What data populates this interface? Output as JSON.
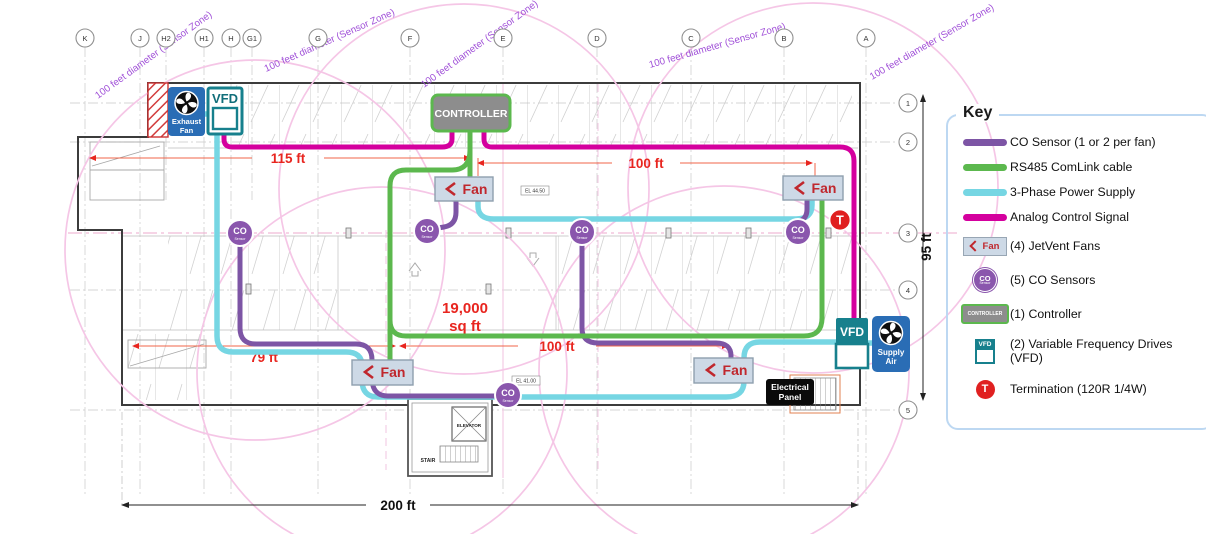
{
  "legend": {
    "title": "Key",
    "items": [
      {
        "label": "CO Sensor (1 or 2 per fan)"
      },
      {
        "label": "RS485 ComLink cable"
      },
      {
        "label": "3-Phase Power Supply"
      },
      {
        "label": "Analog Control Signal"
      },
      {
        "label": "(4) JetVent Fans"
      },
      {
        "label": "(5) CO Sensors"
      },
      {
        "label": "(1) Controller"
      },
      {
        "label": "(2) Variable Frequency Drives (VFD)"
      },
      {
        "label": "Termination (120R 1/4W)"
      }
    ],
    "colors": {
      "co_sensor": "#7d55a5",
      "rs485": "#5cb84e",
      "power": "#76d6e3",
      "analog": "#d4009e"
    }
  },
  "plan": {
    "sensor_zone_label": "100 feet diameter (Sensor Zone)",
    "grid_columns": [
      "K",
      "J",
      "H2",
      "H1",
      "H",
      "G1",
      "G",
      "F",
      "E",
      "D",
      "C",
      "B",
      "A"
    ],
    "grid_rows": [
      "1",
      "2",
      "3",
      "4",
      "5"
    ],
    "dims": {
      "d115": "115 ft",
      "d100_top": "100 ft",
      "d79": "79 ft",
      "d100_bottom": "100 ft",
      "d200": "200 ft",
      "d95": "95 ft",
      "area1": "19,000",
      "area2": "sq ft"
    },
    "devices": {
      "vfd": "VFD",
      "controller": "CONTROLLER",
      "fan": "Fan",
      "co": "CO",
      "co_sub": "Sensor",
      "termination": "T",
      "exhaust1": "Exhaust",
      "exhaust2": "Fan",
      "supply1": "Supply",
      "supply2": "Air",
      "panel1": "Electrical",
      "panel2": "Panel"
    },
    "rooms": {
      "elevator": "ELEVATOR",
      "stair": "STAIR"
    },
    "elevations": {
      "el1": "EL 44.50",
      "el2": "EL 41.00"
    }
  }
}
